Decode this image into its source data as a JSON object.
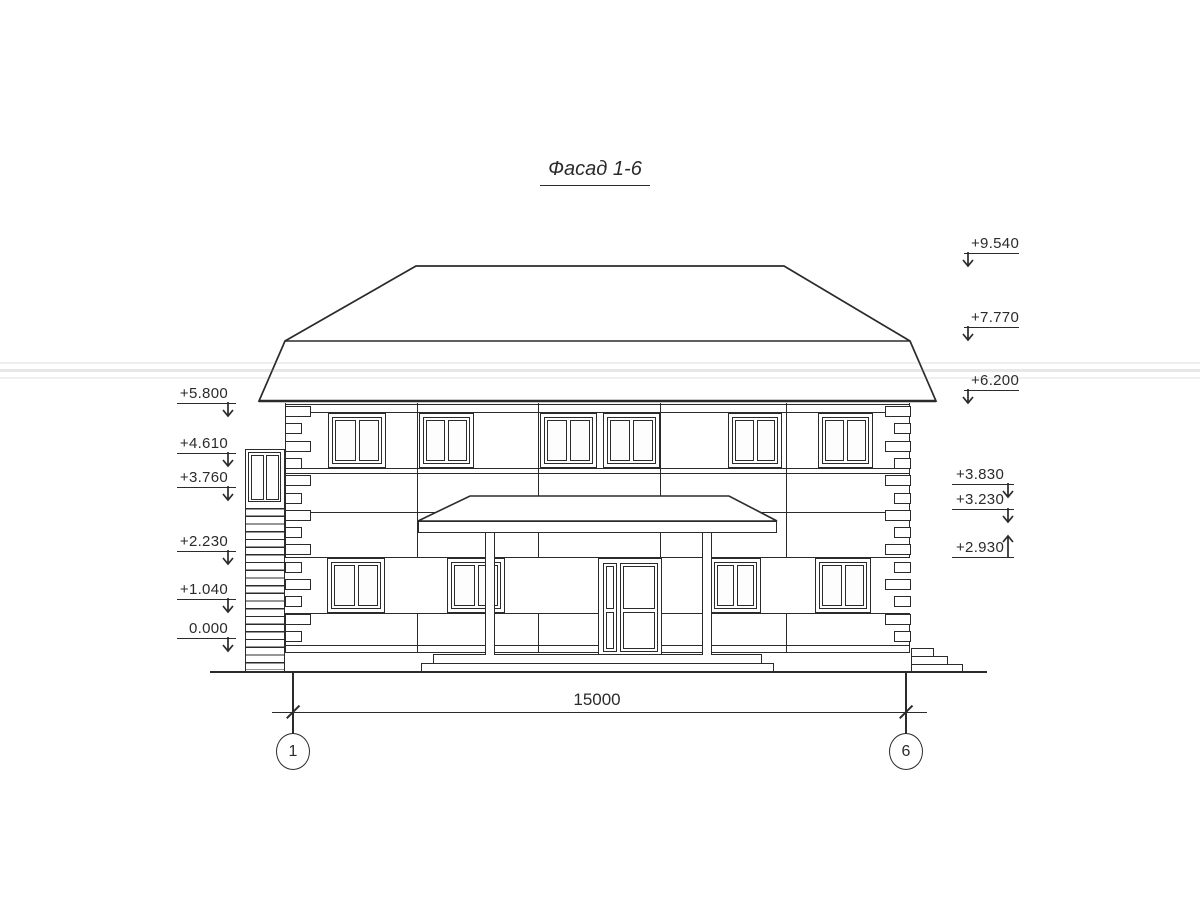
{
  "title": "Фасад 1-6",
  "marks": {
    "left": [
      "+5.800",
      "+4.610",
      "+3.760",
      "+2.230",
      "+1.040",
      "0.000"
    ],
    "right_upper": [
      "+9.540",
      "+7.770",
      "+6.200"
    ],
    "right_lower": [
      "+3.830",
      "+3.230",
      "+2.930"
    ]
  },
  "dimension": {
    "overall": "15000"
  },
  "axes": {
    "left": "1",
    "right": "6"
  },
  "colors": {
    "ink": "#2b2b2b",
    "paper": "#ffffff"
  }
}
